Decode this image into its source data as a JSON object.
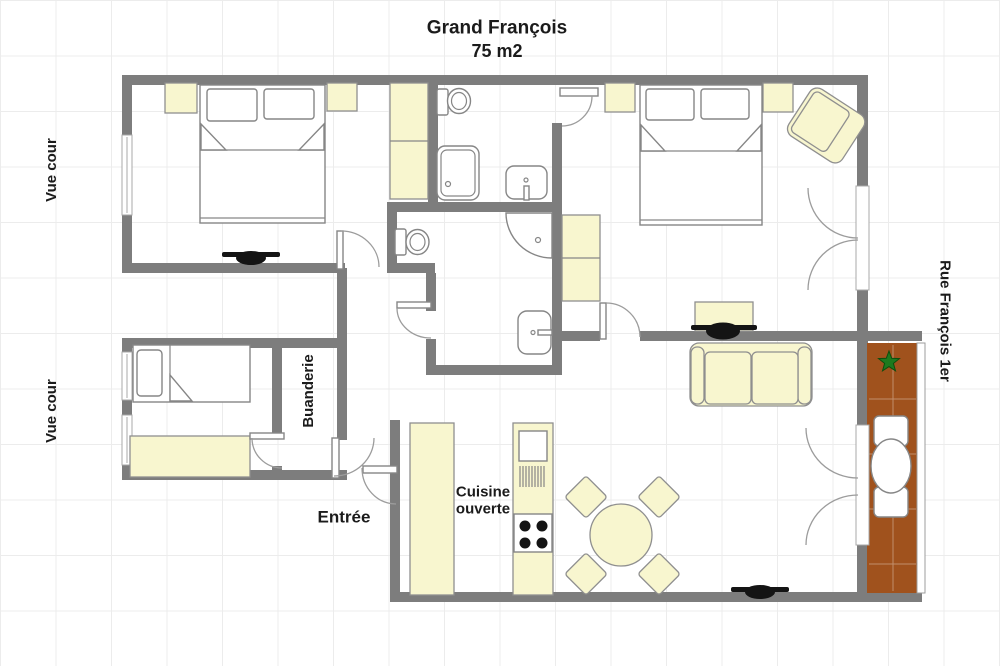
{
  "title": {
    "name": "Grand François",
    "area": "75 m2"
  },
  "labels": {
    "left_top": "Vue cour",
    "left_bottom": "Vue cour",
    "right_street": "Rue François 1er",
    "laundry": "Buanderie",
    "entry": "Entrée",
    "kitchen_line1": "Cuisine",
    "kitchen_line2": "ouverte"
  },
  "icons": {
    "plant": "star-plant-icon"
  },
  "colors": {
    "wall": "#7d7d7d",
    "furniture_fill": "#f8f6cf",
    "furniture_stroke": "#8f8f8f",
    "balcony": "#a0521d",
    "plant": "#1e7a1e",
    "text": "#1b1b1b",
    "grid": "#ececec",
    "dark": "#141414"
  }
}
